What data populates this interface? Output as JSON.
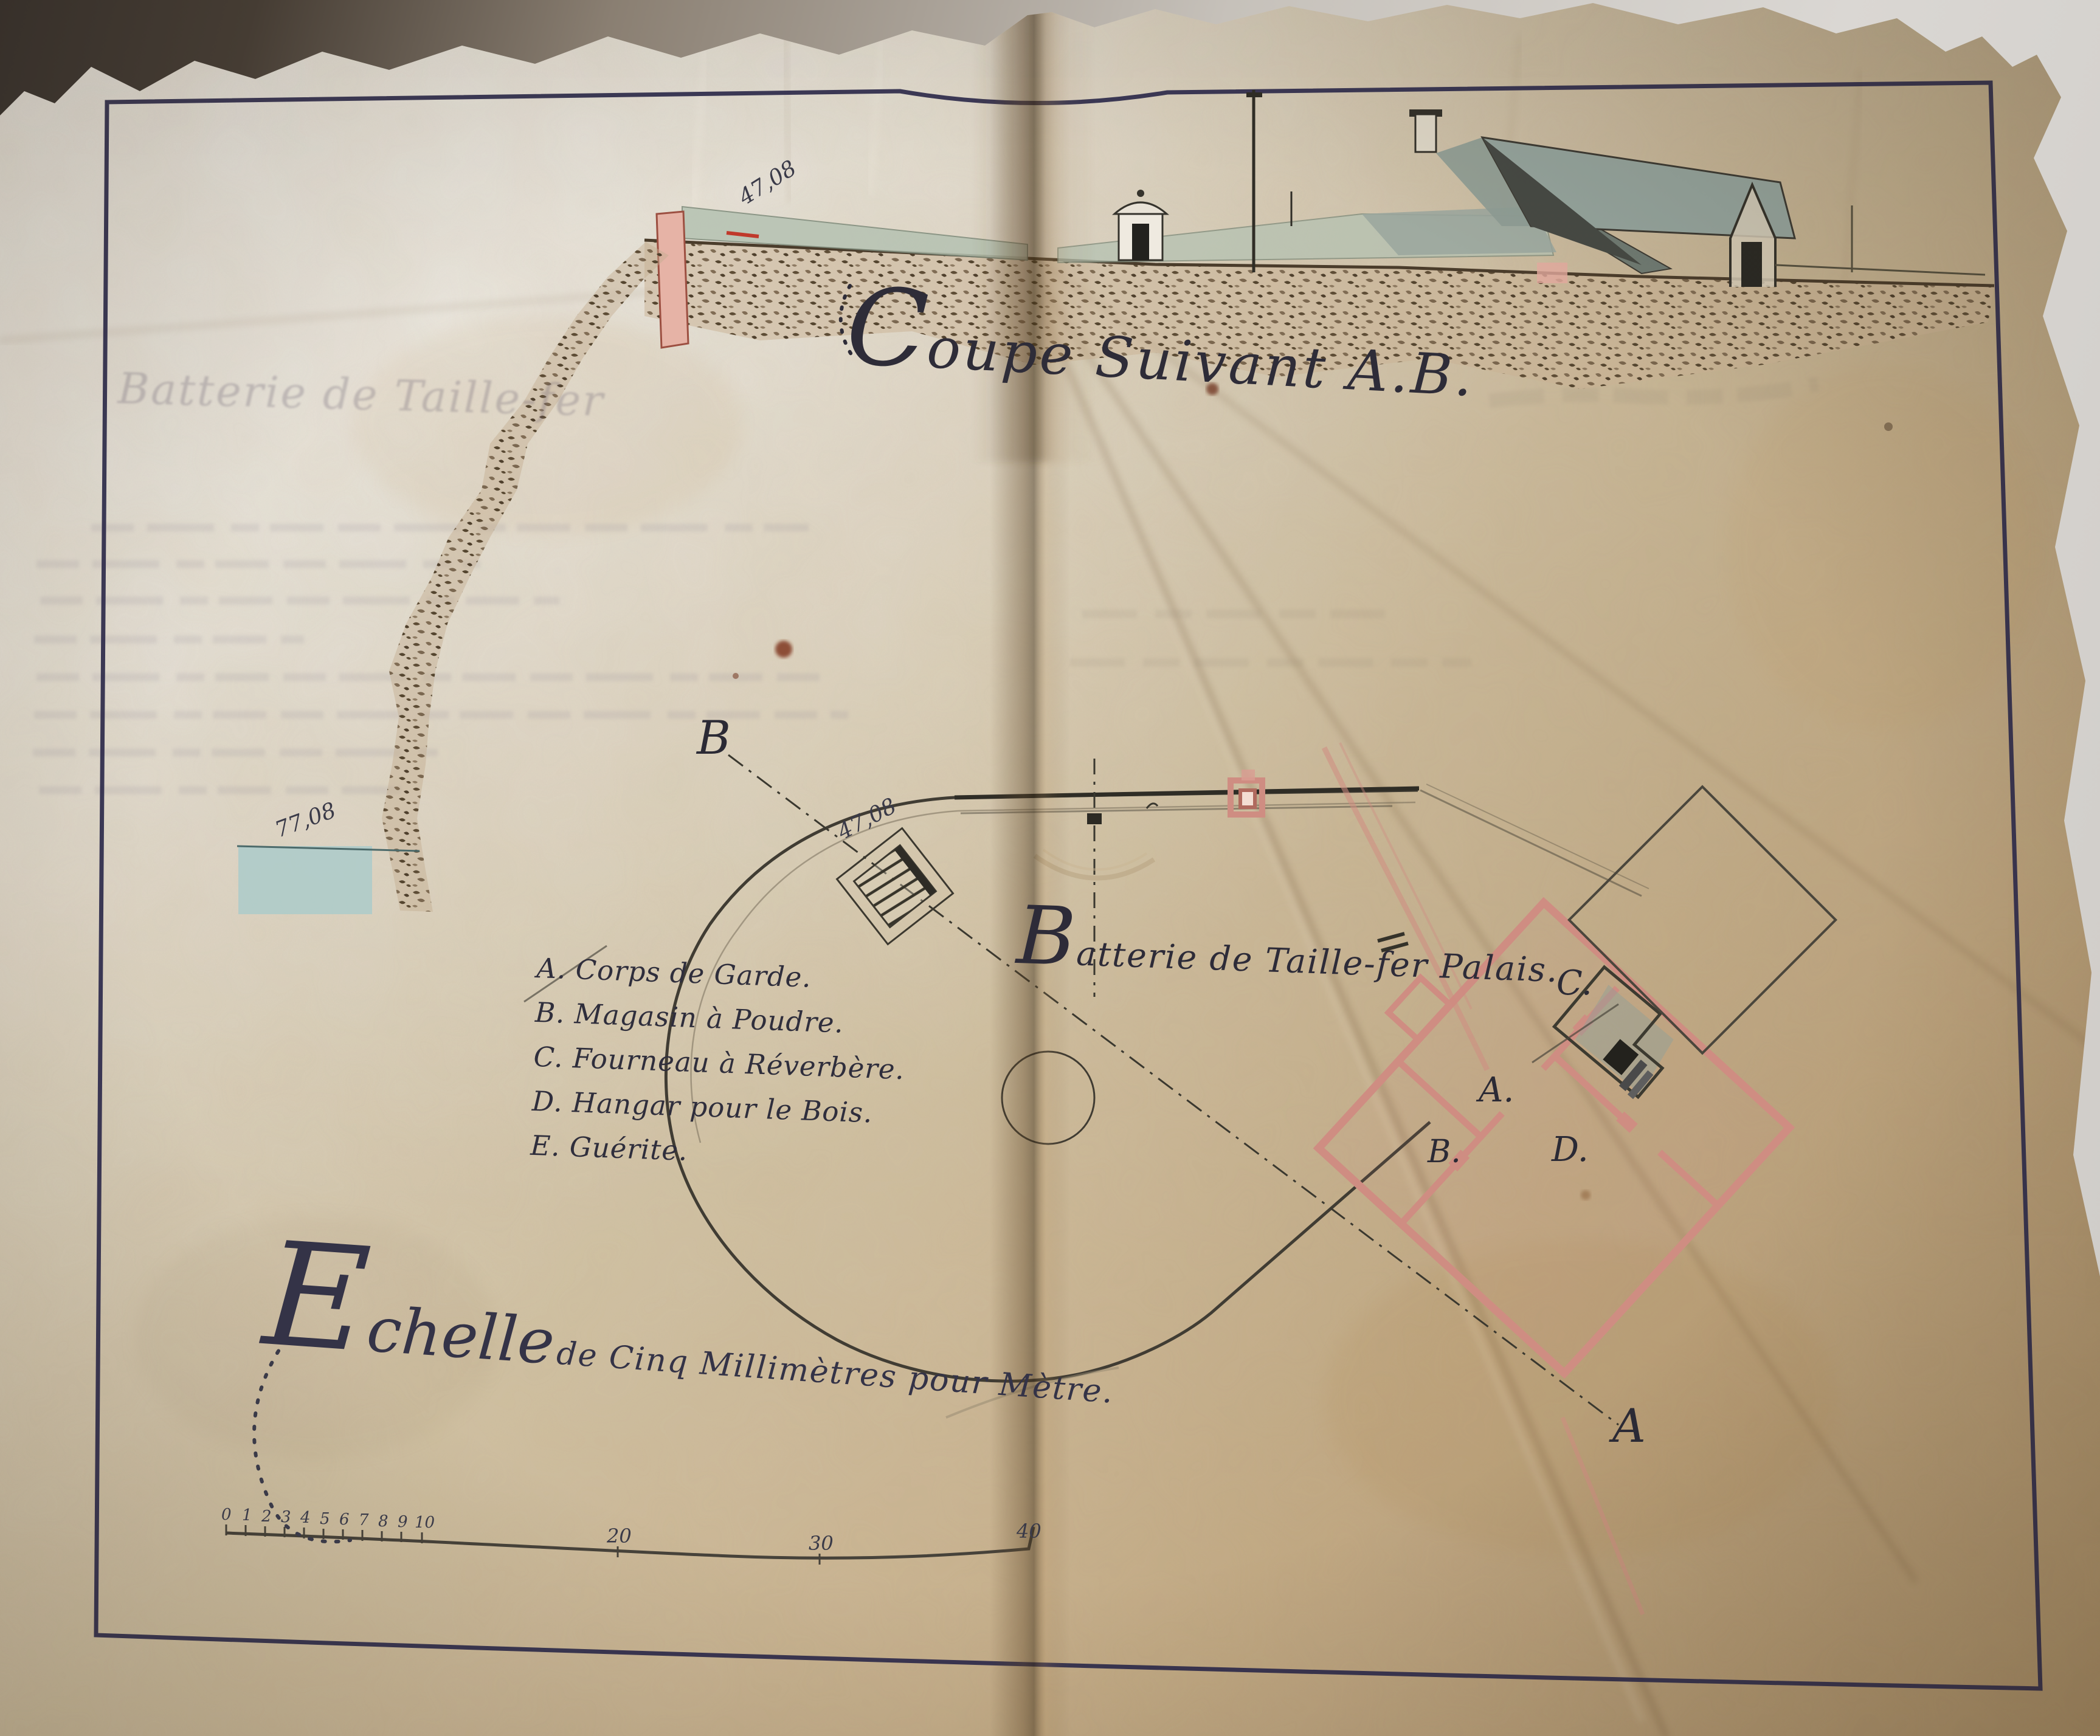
{
  "titles": {
    "section_title": "Coupe Suivant A.B.",
    "faded_header": "Batterie de Taille-fer",
    "battery_label": "Batterie de Taille-fer Palais."
  },
  "legend": {
    "items": [
      {
        "text": "A. Corps de Garde."
      },
      {
        "text": "B. Magasin à Poudre."
      },
      {
        "text": "C. Fourneau à Réverbère."
      },
      {
        "text": "D. Hangar pour le Bois."
      },
      {
        "text": "E. Guérite."
      }
    ]
  },
  "scale": {
    "initial": "E",
    "word_rest": "chelle",
    "caption_rest": "de Cinq Millimètres pour Mètre.",
    "bar_units": [
      "0",
      "1",
      "2",
      "3",
      "4",
      "5",
      "6",
      "7",
      "8",
      "9",
      "10"
    ],
    "bar_tens": [
      "20",
      "30",
      "40"
    ]
  },
  "annotations": {
    "section_elevation": "47,08",
    "plan_elevation": "47,08",
    "shore_elevation": "77,08",
    "section_point_b": "B",
    "section_point_a": "A",
    "room_c": "C.",
    "room_a": "A.",
    "room_b": "B.",
    "room_d": "D."
  },
  "colors": {
    "paper_light": "#e3ded2",
    "paper_tan": "#c8ab85",
    "frame_ink": "#2c2a4c",
    "drawing_ink": "#3a362c",
    "script_ink": "#2e2c3a",
    "wall_red": "#cf8d82",
    "glacis_green": "#b5c2b2",
    "roof_slate": "#94a39c",
    "sea_blue": "#a9caca",
    "rock_brown": "#5a4a34"
  }
}
